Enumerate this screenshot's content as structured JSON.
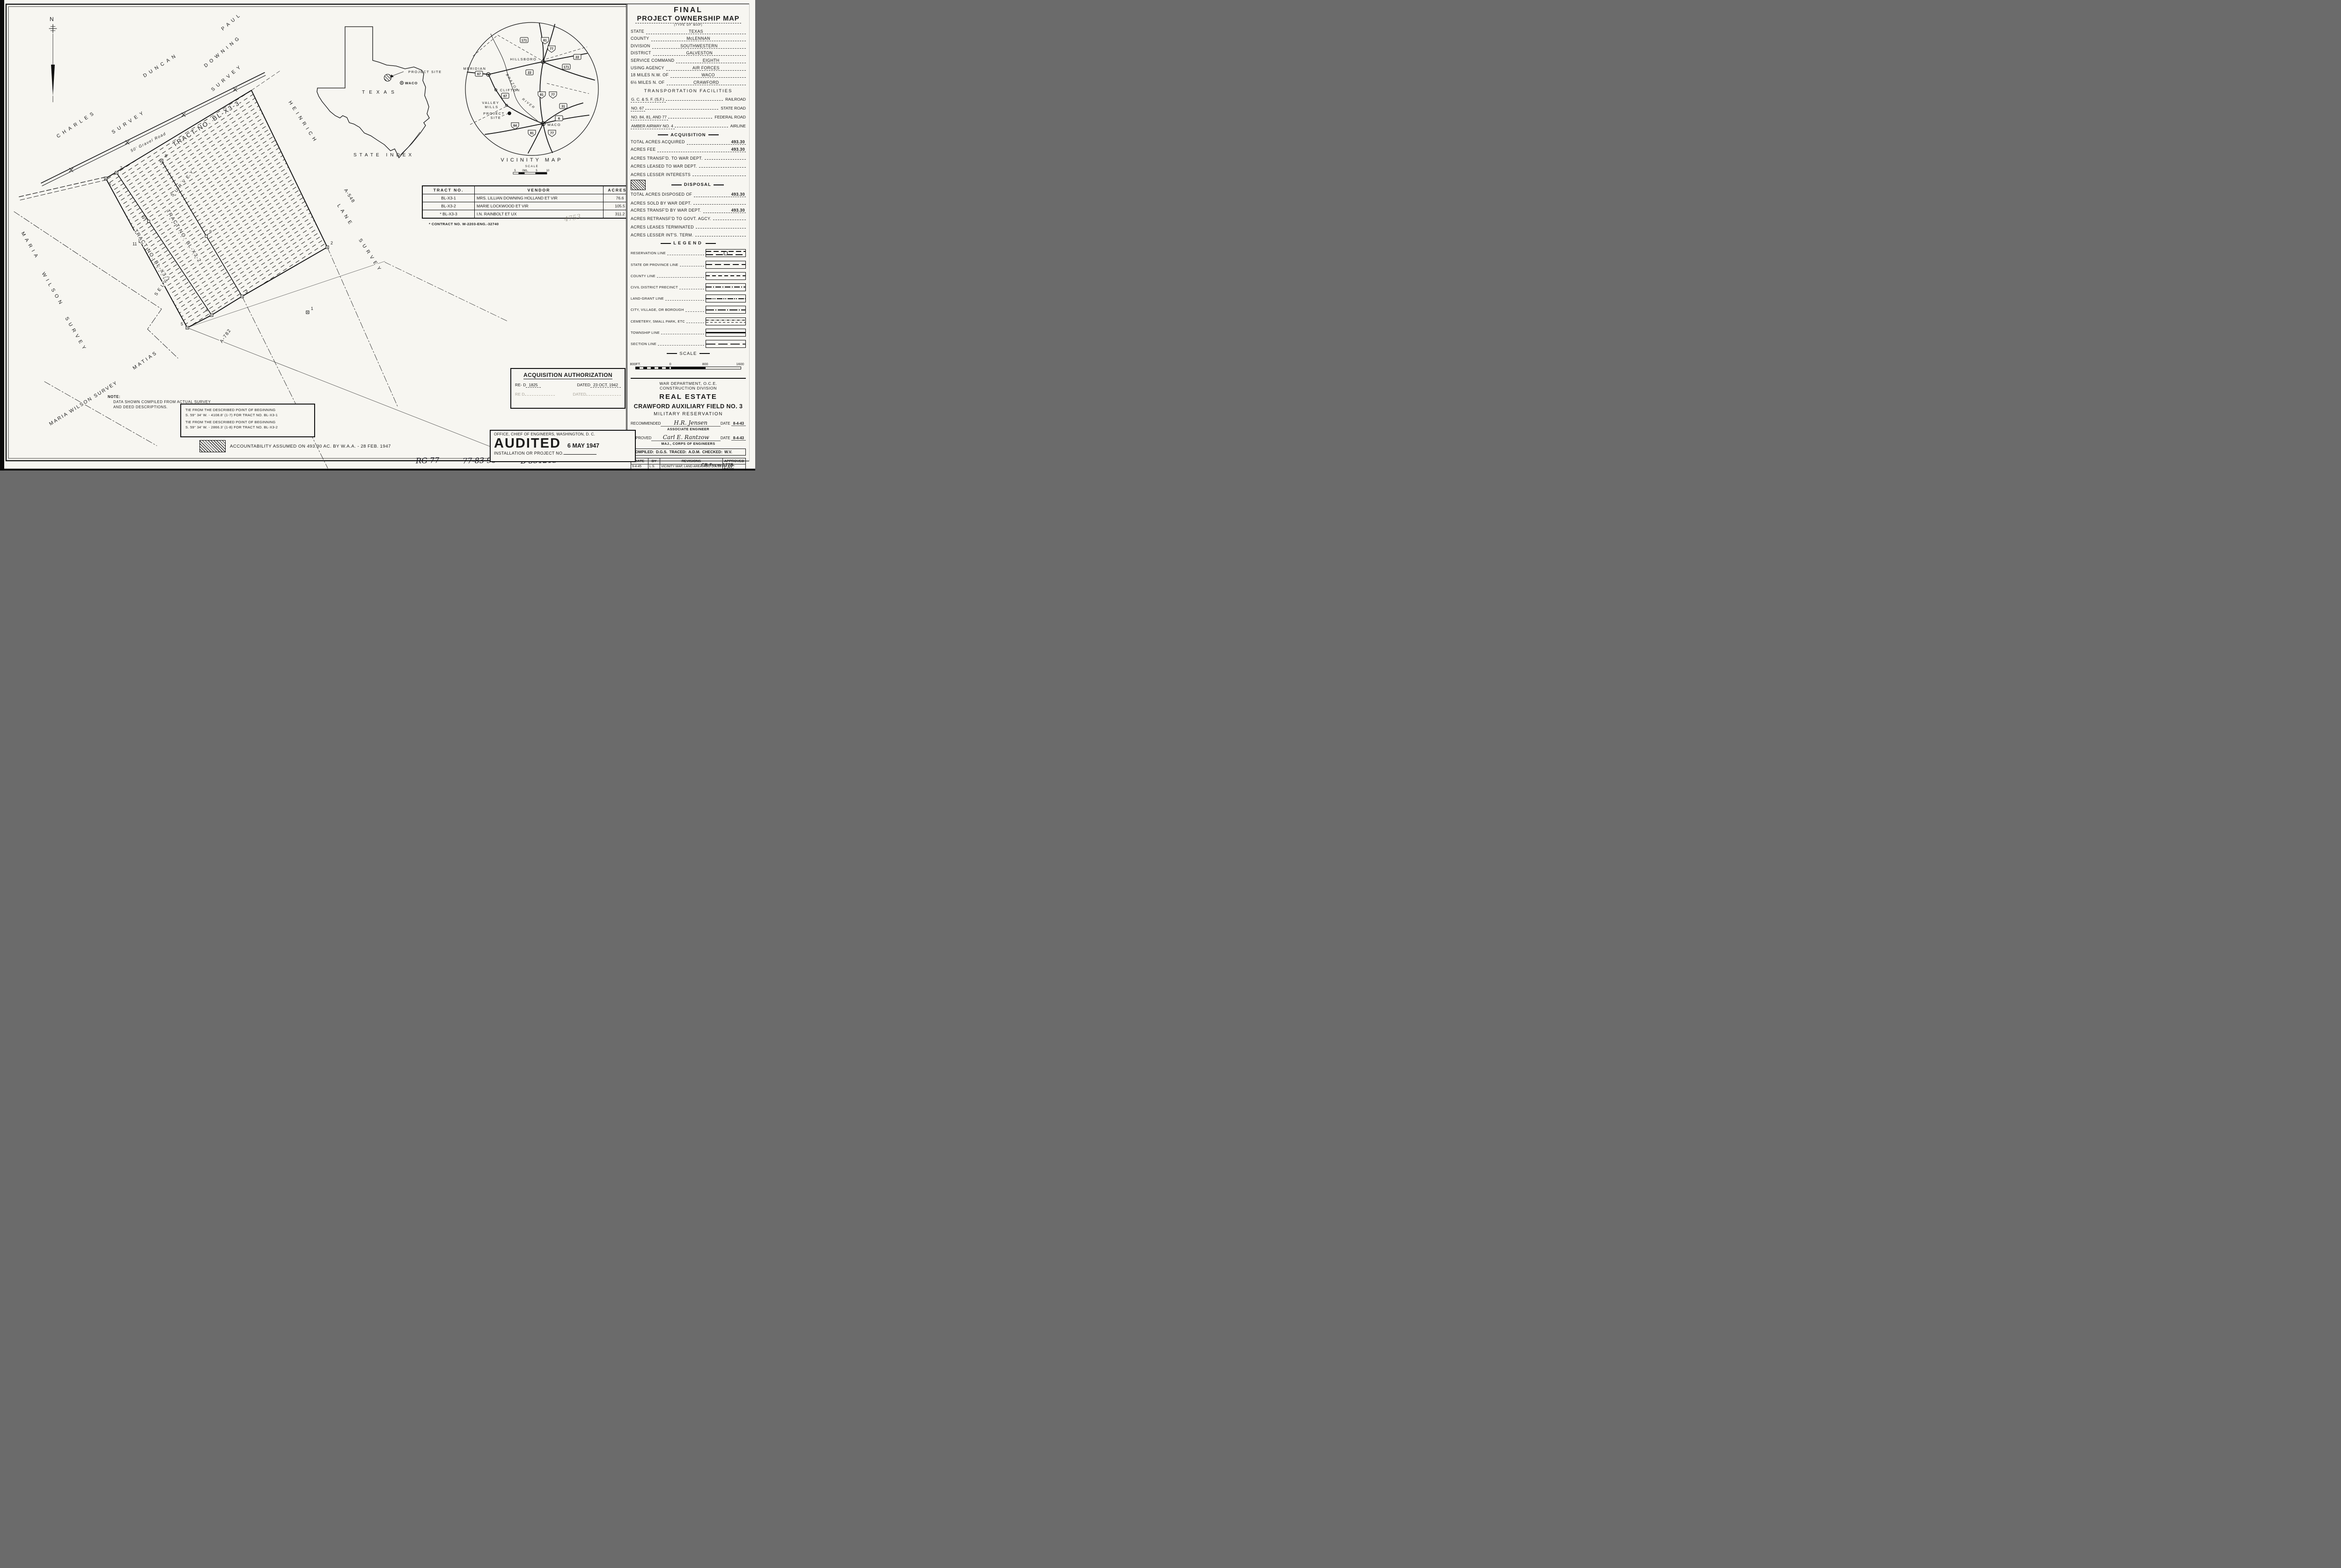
{
  "sheet": {
    "form_no": "CR-Form-177B",
    "handwritten": [
      "RG 77",
      "77-83-96",
      "B 351213"
    ]
  },
  "title_block": {
    "line1": "FINAL",
    "line2": "PROJECT OWNERSHIP MAP",
    "type_caption": "(TYPE OF MAP)",
    "fields": [
      {
        "label": "STATE",
        "value": "TEXAS"
      },
      {
        "label": "COUNTY",
        "value": "McLENNAN"
      },
      {
        "label": "DIVISION",
        "value": "SOUTHWESTERN"
      },
      {
        "label": "DISTRICT",
        "value": "GALVESTON"
      },
      {
        "label": "SERVICE COMMAND",
        "value": "EIGHTH"
      },
      {
        "label": "USING AGENCY",
        "value": "AIR FORCES"
      },
      {
        "label": "18 MILES N.W. OF",
        "value": "WACO"
      },
      {
        "label": "6½ MILES N. OF",
        "value": "CRAWFORD"
      }
    ]
  },
  "transportation": {
    "header": "TRANSPORTATION FACILITIES",
    "rows": [
      {
        "value": "G. C. & S. F. (S,F.)",
        "label": "RAILROAD"
      },
      {
        "value": "NO. 67",
        "label": "STATE ROAD"
      },
      {
        "value": "NO. 84, 81, AND 77",
        "label": "FEDERAL ROAD"
      },
      {
        "value": "AMBER AIRWAY NO. 4",
        "label": "AIRLINE"
      }
    ]
  },
  "acquisition": {
    "header": "ACQUISITION",
    "rows": [
      {
        "label": "TOTAL ACRES ACQUIRED",
        "value": "493.30"
      },
      {
        "label": "ACRES FEE",
        "value": "493.30"
      },
      {
        "label": "ACRES TRANSF'D. TO WAR DEPT.",
        "value": ""
      },
      {
        "label": "ACRES LEASED TO WAR DEPT.",
        "value": ""
      },
      {
        "label": "ACRES LESSER INTERESTS",
        "value": ""
      }
    ]
  },
  "disposal": {
    "header": "DISPOSAL",
    "rows": [
      {
        "label": "TOTAL ACRES DISPOSED OF",
        "value": "493.30"
      },
      {
        "label": "ACRES SOLD BY WAR DEPT.",
        "value": ""
      },
      {
        "label": "ACRES TRANSF'D BY WAR DEPT.",
        "value": "493.30"
      },
      {
        "label": "ACRES RETRANSF'D TO GOVT. AGCY.",
        "value": ""
      },
      {
        "label": "ACRES LEASES TERMINATED",
        "value": ""
      },
      {
        "label": "ACRES LESSER INT'S. TERM.",
        "value": ""
      }
    ]
  },
  "legend": {
    "header": "LEGEND",
    "items": [
      "RESERVATION LINE",
      "STATE OR PROVINCE LINE",
      "COUNTY LINE",
      "CIVIL DISTRICT PRECINCT",
      "LAND-GRANT LINE",
      "CITY, VILLAGE, OR BOROUGH",
      "CEMETERY, SMALL PARK, ETC",
      "TOWNSHIP LINE",
      "SECTION LINE"
    ]
  },
  "scale": {
    "header": "SCALE",
    "labels": [
      "800FT.",
      "0",
      "800",
      "1600"
    ]
  },
  "agency": {
    "l1": "WAR DEPARTMENT, O.C.E.",
    "l2": "CONSTRUCTION DIVISION",
    "l3": "REAL ESTATE",
    "l4": "CRAWFORD AUXILIARY FIELD NO. 3",
    "l5": "MILITARY RESERVATION",
    "recommended_label": "RECOMMENDED",
    "recommended_sig": "H.R. Jensen",
    "recommended_date_label": "DATE",
    "recommended_date": "8-4-43",
    "recommended_title": "ASSOCIATE ENGINEER",
    "approved_label": "APPROVED",
    "approved_sig": "Carl E. Rantzow",
    "approved_date_label": "DATE",
    "approved_date": "8-4-43",
    "approved_title": "MAJ., CORPS OF ENGINEERS"
  },
  "compiled": {
    "c_label": "COMPILED:",
    "c": "D.G.S.",
    "t_label": "TRACED:",
    "t": "A.D.M.",
    "k_label": "CHECKED:",
    "k": "W.V."
  },
  "revisions": {
    "headers": [
      "DATE",
      "BY",
      "REVISIONS",
      "APPROVED"
    ],
    "rows": [
      {
        "date": "9-4-45",
        "by": "L.S.",
        "text": "VICINITY MAP, LAND AREA, ADD C.A.187.",
        "approved": "ERC"
      },
      {
        "date": "″ ″",
        "by": "″",
        "text": "ADD CONTRACT NO., ADD DIRECTIVE,",
        "approved": ""
      },
      {
        "date": "″ ″",
        "by": "″",
        "text": "ADD FINAL, CHANGE TITLE.",
        "approved": ""
      },
      {
        "date": "5-6-47",
        "by": "F.E.L",
        "text": "VENDORS CORRECTED, TITLE CHANGED,",
        "approved": ""
      },
      {
        "date": "",
        "by": "",
        "text": "DISPOSAL ADDED",
        "approved": ""
      }
    ]
  },
  "sheet_row": {
    "sheet_label": "SHEET:",
    "sheet": "1",
    "of_label": "OF",
    "of": "1 .",
    "drawing_label": "DRAWING NO.",
    "drawing": "BRAZ-540-92L"
  },
  "tract_table": {
    "headers": [
      "TRACT NO.",
      "VENDOR",
      "ACRES ±"
    ],
    "rows": [
      {
        "tract": "BL-X3-1",
        "vendor": "MRS. LILLIAN DOWNING HOLLAND ET VIR",
        "acres": "76.6"
      },
      {
        "tract": "BL-X3-2",
        "vendor": "MARIE LOCKWOOD ET VIR",
        "acres": "105.5"
      },
      {
        "tract": "* BL-X3-3",
        "vendor": "I.N. RAINBOLT ET UX",
        "acres": "311.2"
      }
    ],
    "footnote": "* CONTRACT NO. W-2203-ENG.-32740",
    "pencil": "4753"
  },
  "acq_auth": {
    "title": "ACQUISITION AUTHORIZATION",
    "row1_label": "RE- D",
    "row1_value": "1825",
    "row1_date_label": "DATED",
    "row1_date": "23 OCT. 1942",
    "row2_label": "RE  D",
    "row2_value": "",
    "row2_date_label": "DATED",
    "row2_date": ""
  },
  "audited": {
    "office": "OFFICE, CHIEF OF ENGINEERS, WASHINGTON, D. C.",
    "stamp": "AUDITED",
    "date": "6 MAY 1947",
    "line": "INSTALLATION OR PROJECT NO."
  },
  "notes": {
    "note_label": "NOTE:",
    "line1": "DATA SHOWN COMPILED FROM ACTUAL SURVEY",
    "line2": "AND DEED DESCRIPTIONS.",
    "tie1a": "TIE FROM THE DESCRIBED POINT OF BEGINNING",
    "tie1b": "S. 59° 34' W. - 4108.8' (1-7) FOR TRACT NO. BL-X3-1",
    "tie2a": "TIE FROM THE DESCRIBED POINT OF BEGINNING",
    "tie2b": "S. 59° 34' W. - 2866.3' (1-8) FOR TRACT NO. BL-X3-2",
    "accountability": "ACCOUNTABILITY ASSUMED ON 493.30 AC. BY W.A.A. - 28 FEB. 1947"
  },
  "state_index": {
    "title": "STATE INDEX",
    "state_label": "TEXAS",
    "project_site": "PROJECT SITE",
    "waco": "WACO"
  },
  "vicinity": {
    "title": "VICINITY MAP",
    "scale_label": "SCALE",
    "ticks": [
      "5",
      "0ML.",
      "5",
      "10"
    ],
    "towns": {
      "hillsboro": "HILLSBORO",
      "meridian": "MERIDIAN",
      "clifton": "CLIFTON",
      "valley1": "VALLEY",
      "valley2": "MILLS",
      "project1": "PROJECT",
      "project2": "SITE",
      "waco": "WACO"
    },
    "river1": "BRAZOS",
    "river2": "RIVER",
    "shields": [
      "171",
      "81",
      "77",
      "22",
      "171",
      "22",
      "67",
      "67",
      "81",
      "77",
      "31",
      "6",
      "84",
      "81",
      "77"
    ]
  },
  "map": {
    "north": "N",
    "road": "50' Gravel Road",
    "surveys": {
      "paul": "PAUL",
      "downing": "DOWNING",
      "paul_survey": "SURVEY",
      "charles": "CHARLES",
      "duncan": "DUNCAN",
      "duncan_survey": "SURVEY",
      "heinrich": "HEINRICH",
      "lane": "LANE",
      "lane_survey": "SURVEY",
      "maria1": "MARIA",
      "wilson1": "WILSON",
      "survey1": "SURVEY",
      "maria_wilson2": "MARIA WILSON SURVEY",
      "matias": "MATIAS",
      "selva": "SELVA",
      "selva_survey": "SURVEY"
    },
    "tracts": {
      "t3": "TRACT NO. BL-X3-3",
      "t2": "TRACT NO. BL-X3-2",
      "t1": "TRACT NO. BL-X3-1"
    },
    "abstracts": {
      "a548": "A-548",
      "a782": "A-782"
    },
    "vertices": [
      "1",
      "2",
      "3",
      "4",
      "5",
      "6",
      "7",
      "8",
      "9",
      "10",
      "11"
    ]
  }
}
